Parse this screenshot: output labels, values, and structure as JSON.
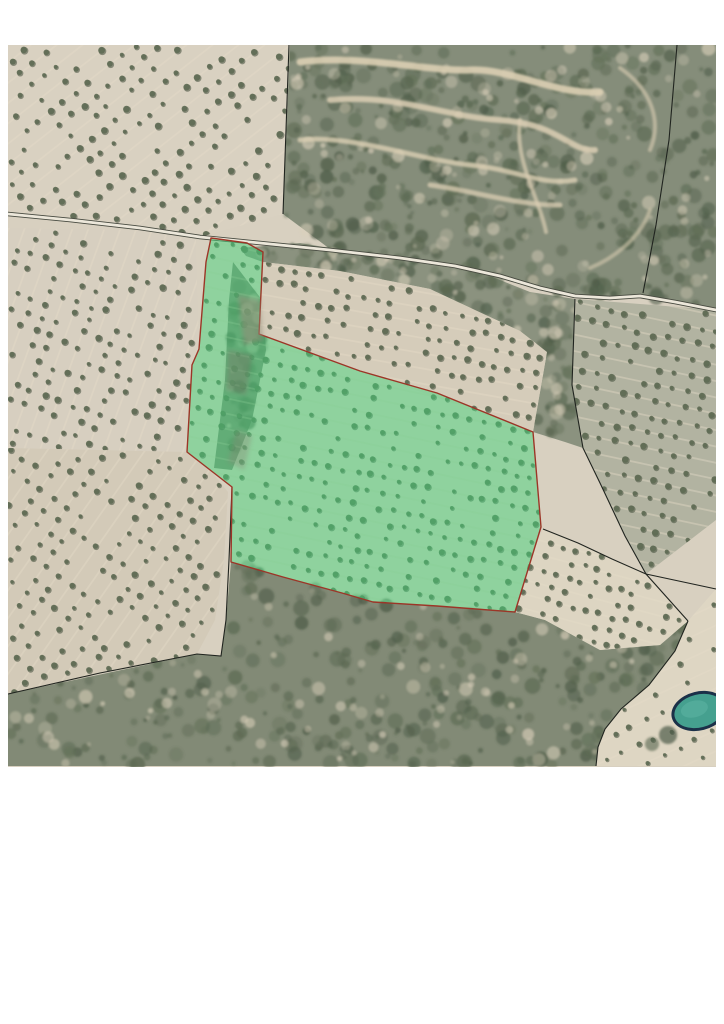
{
  "page": {
    "background_color": "#ffffff",
    "width": 724,
    "height": 1024
  },
  "aerial_photo": {
    "left": 8,
    "top": 45,
    "width": 708,
    "height": 722,
    "base_sand_color": "#d8d0c0",
    "scrub_color": "#868e7b"
  },
  "parcel_overlay": {
    "fill_color": "#46d47c",
    "fill_opacity": 0.5,
    "outline_color": "#9c3527",
    "outline_width": 1.4,
    "points": [
      [
        211,
        238
      ],
      [
        247,
        243
      ],
      [
        263,
        252
      ],
      [
        259,
        334
      ],
      [
        360,
        371
      ],
      [
        437,
        393
      ],
      [
        533,
        432
      ],
      [
        541,
        527
      ],
      [
        515,
        612
      ],
      [
        437,
        606
      ],
      [
        373,
        602
      ],
      [
        342,
        593
      ],
      [
        283,
        577
      ],
      [
        231,
        562
      ],
      [
        232,
        487
      ],
      [
        187,
        452
      ],
      [
        192,
        365
      ],
      [
        199,
        349
      ],
      [
        206,
        262
      ]
    ]
  },
  "road": {
    "casing_color": "#474a40",
    "surface_color": "#ece7da",
    "points": [
      [
        8,
        214
      ],
      [
        70,
        220
      ],
      [
        140,
        228
      ],
      [
        200,
        237
      ],
      [
        260,
        243
      ],
      [
        330,
        250
      ],
      [
        400,
        258
      ],
      [
        455,
        266
      ],
      [
        500,
        276
      ],
      [
        540,
        288
      ],
      [
        575,
        296
      ],
      [
        610,
        298
      ],
      [
        640,
        296
      ],
      [
        675,
        302
      ],
      [
        716,
        310
      ]
    ]
  },
  "boundary_lines": {
    "color": "#20241f",
    "width": 1.1,
    "lines": [
      [
        [
          289,
          45
        ],
        [
          286,
          130
        ],
        [
          283,
          214
        ]
      ],
      [
        [
          677,
          45
        ],
        [
          669,
          140
        ],
        [
          656,
          225
        ],
        [
          643,
          293
        ]
      ],
      [
        [
          575,
          299
        ],
        [
          572,
          385
        ],
        [
          583,
          448
        ],
        [
          600,
          483
        ],
        [
          625,
          536
        ],
        [
          646,
          574
        ],
        [
          688,
          621
        ]
      ],
      [
        [
          543,
          529
        ],
        [
          578,
          543
        ],
        [
          612,
          559
        ],
        [
          646,
          574
        ]
      ],
      [
        [
          646,
          574
        ],
        [
          716,
          589
        ]
      ],
      [
        [
          688,
          621
        ],
        [
          675,
          651
        ],
        [
          649,
          685
        ],
        [
          621,
          709
        ],
        [
          605,
          729
        ],
        [
          598,
          747
        ],
        [
          596,
          766
        ]
      ],
      [
        [
          8,
          694
        ],
        [
          100,
          673
        ],
        [
          197,
          654
        ],
        [
          221,
          656
        ],
        [
          226,
          620
        ],
        [
          229,
          560
        ],
        [
          232,
          487
        ]
      ]
    ]
  },
  "pond": {
    "cx": 699,
    "cy": 711,
    "rx": 25,
    "ry": 16.5,
    "rotation": -14,
    "water_color": "#45a08f",
    "edge_color": "#1b3048"
  }
}
